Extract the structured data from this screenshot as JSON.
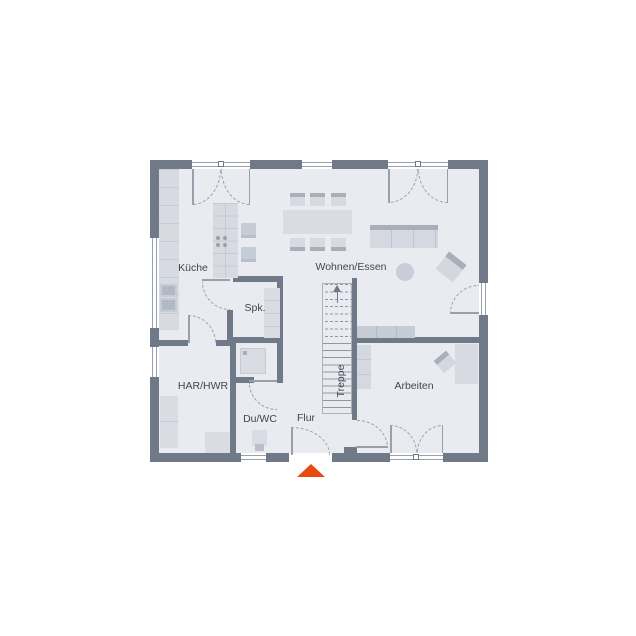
{
  "rooms": {
    "kitchen": "Küche",
    "living": "Wohnen/Essen",
    "pantry": "Spk.",
    "utility": "HAR/HWR",
    "wc": "Du/WC",
    "hall": "Flur",
    "stairs": "Treppe",
    "office": "Arbeiten"
  },
  "icons": {
    "entrance_marker": "triangle-up",
    "stairs_direction": "arrow-up"
  },
  "colors": {
    "wall": "#6f7987",
    "floor": "#e9ebf0",
    "line": "#98a0ae",
    "furn": "#d7dae1",
    "furn2": "#c6ccd6",
    "dark": "#a8aeba",
    "appl": "#b2b8c4",
    "text": "#40464f",
    "accent": "#e8490e",
    "win": "#ffffff"
  }
}
